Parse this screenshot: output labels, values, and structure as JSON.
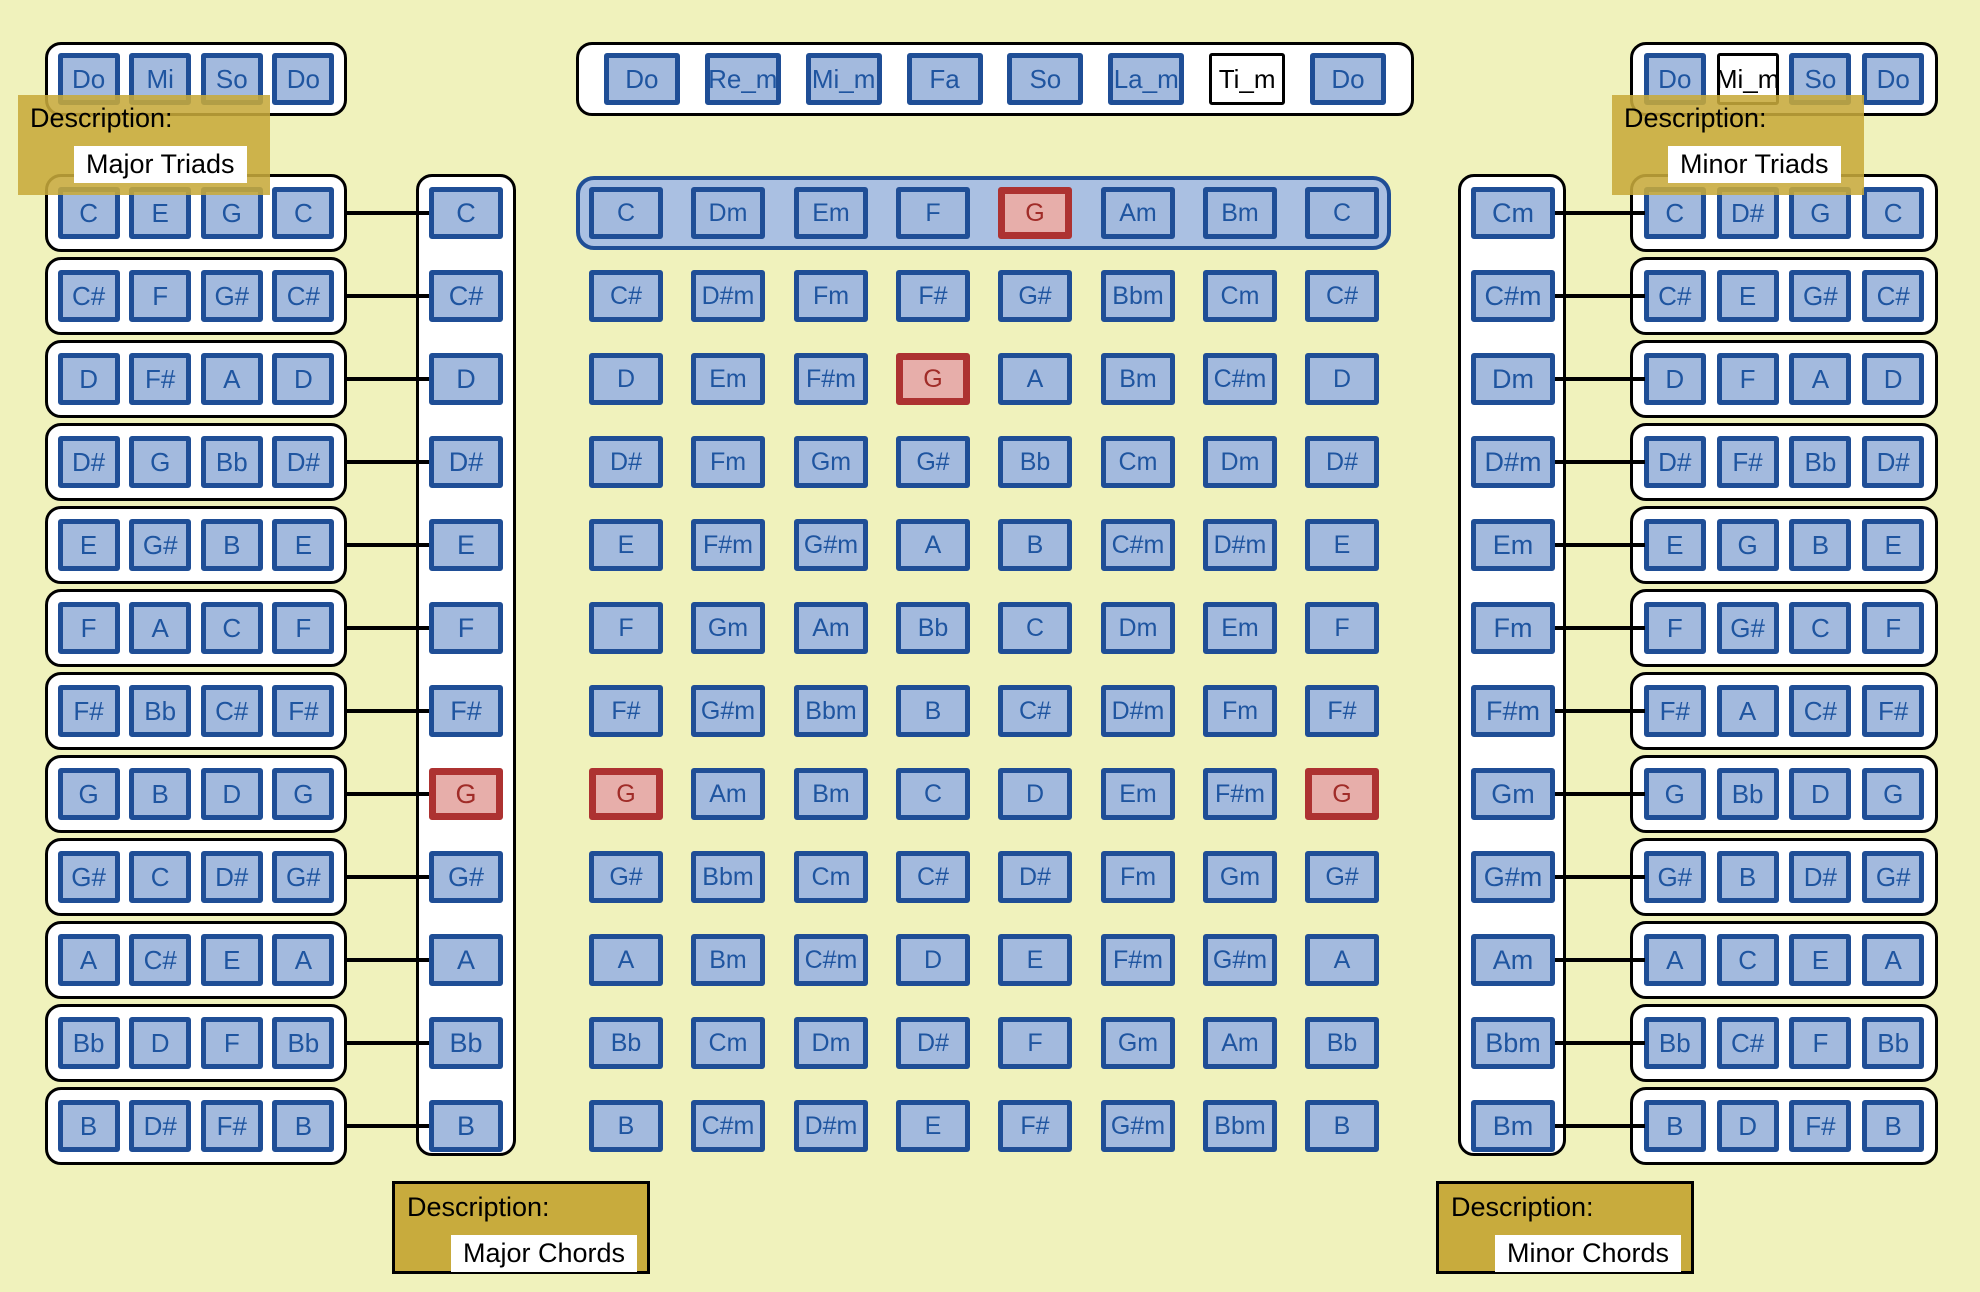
{
  "palette": {
    "background": "#f0f2bc",
    "box_fill": "#a3bade",
    "box_border": "#1f4e96",
    "box_text": "#1f55a0",
    "highlight_fill": "#e7aeaa",
    "highlight_border": "#ad3231",
    "highlight_text": "#a02c28",
    "group_fill": "#ffffff",
    "group_border": "#000000",
    "row_container_fill": "#aac0e2",
    "label_gold": "#c8ab3d"
  },
  "top_row": {
    "major_scale_group": {
      "cells": [
        "Do",
        "Mi",
        "So",
        "Do"
      ]
    },
    "solfege_group": {
      "cells": [
        "Do",
        "Re_m",
        "Mi_m",
        "Fa",
        "So",
        "La_m",
        {
          "label": "Ti_m",
          "variant": "white"
        },
        "Do"
      ]
    },
    "minor_scale_group": {
      "cells": [
        "Do",
        {
          "label": "Mi_m",
          "variant": "white"
        },
        "So",
        "Do"
      ]
    }
  },
  "tooltips": {
    "major_triads": {
      "title": "Description:",
      "value": "Major Triads"
    },
    "minor_triads": {
      "title": "Description:",
      "value": "Minor Triads"
    }
  },
  "descriptions": {
    "major_chords": {
      "title": "Description:",
      "value": "Major Chords"
    },
    "minor_chords": {
      "title": "Description:",
      "value": "Minor Chords"
    }
  },
  "left_panel": {
    "triad_rows": [
      [
        "C",
        "E",
        "G",
        "C"
      ],
      [
        "C#",
        "F",
        "G#",
        "C#"
      ],
      [
        "D",
        "F#",
        "A",
        "D"
      ],
      [
        "D#",
        "G",
        "Bb",
        "D#"
      ],
      [
        "E",
        "G#",
        "B",
        "E"
      ],
      [
        "F",
        "A",
        "C",
        "F"
      ],
      [
        "F#",
        "Bb",
        "C#",
        "F#"
      ],
      [
        "G",
        "B",
        "D",
        "G"
      ],
      [
        "G#",
        "C",
        "D#",
        "G#"
      ],
      [
        "A",
        "C#",
        "E",
        "A"
      ],
      [
        "Bb",
        "D",
        "F",
        "Bb"
      ],
      [
        "B",
        "D#",
        "F#",
        "B"
      ]
    ],
    "chord_column": [
      "C",
      "C#",
      "D",
      "D#",
      "E",
      "F",
      "F#",
      {
        "label": "G",
        "variant": "red"
      },
      "G#",
      "A",
      "Bb",
      "B"
    ]
  },
  "center_grid": {
    "highlighted_row_index": 0,
    "rows": [
      [
        "C",
        "Dm",
        "Em",
        "F",
        {
          "label": "G",
          "variant": "red"
        },
        "Am",
        "Bm",
        "C"
      ],
      [
        "C#",
        "D#m",
        "Fm",
        "F#",
        "G#",
        "Bbm",
        "Cm",
        "C#"
      ],
      [
        "D",
        "Em",
        "F#m",
        {
          "label": "G",
          "variant": "red"
        },
        "A",
        "Bm",
        "C#m",
        "D"
      ],
      [
        "D#",
        "Fm",
        "Gm",
        "G#",
        "Bb",
        "Cm",
        "Dm",
        "D#"
      ],
      [
        "E",
        "F#m",
        "G#m",
        "A",
        "B",
        "C#m",
        "D#m",
        "E"
      ],
      [
        "F",
        "Gm",
        "Am",
        "Bb",
        "C",
        "Dm",
        "Em",
        "F"
      ],
      [
        "F#",
        "G#m",
        "Bbm",
        "B",
        "C#",
        "D#m",
        "Fm",
        "F#"
      ],
      [
        {
          "label": "G",
          "variant": "red"
        },
        "Am",
        "Bm",
        "C",
        "D",
        "Em",
        "F#m",
        {
          "label": "G",
          "variant": "red"
        }
      ],
      [
        "G#",
        "Bbm",
        "Cm",
        "C#",
        "D#",
        "Fm",
        "Gm",
        "G#"
      ],
      [
        "A",
        "Bm",
        "C#m",
        "D",
        "E",
        "F#m",
        "G#m",
        "A"
      ],
      [
        "Bb",
        "Cm",
        "Dm",
        "D#",
        "F",
        "Gm",
        "Am",
        "Bb"
      ],
      [
        "B",
        "C#m",
        "D#m",
        "E",
        "F#",
        "G#m",
        "Bbm",
        "B"
      ]
    ]
  },
  "right_panel": {
    "chord_column": [
      "Cm",
      "C#m",
      "Dm",
      "D#m",
      "Em",
      "Fm",
      "F#m",
      "Gm",
      "G#m",
      "Am",
      "Bbm",
      "Bm"
    ],
    "triad_rows": [
      [
        "C",
        "D#",
        "G",
        "C"
      ],
      [
        "C#",
        "E",
        "G#",
        "C#"
      ],
      [
        "D",
        "F",
        "A",
        "D"
      ],
      [
        "D#",
        "F#",
        "Bb",
        "D#"
      ],
      [
        "E",
        "G",
        "B",
        "E"
      ],
      [
        "F",
        "G#",
        "C",
        "F"
      ],
      [
        "F#",
        "A",
        "C#",
        "F#"
      ],
      [
        "G",
        "Bb",
        "D",
        "G"
      ],
      [
        "G#",
        "B",
        "D#",
        "G#"
      ],
      [
        "A",
        "C",
        "E",
        "A"
      ],
      [
        "Bb",
        "C#",
        "F",
        "Bb"
      ],
      [
        "B",
        "D",
        "F#",
        "B"
      ]
    ]
  }
}
